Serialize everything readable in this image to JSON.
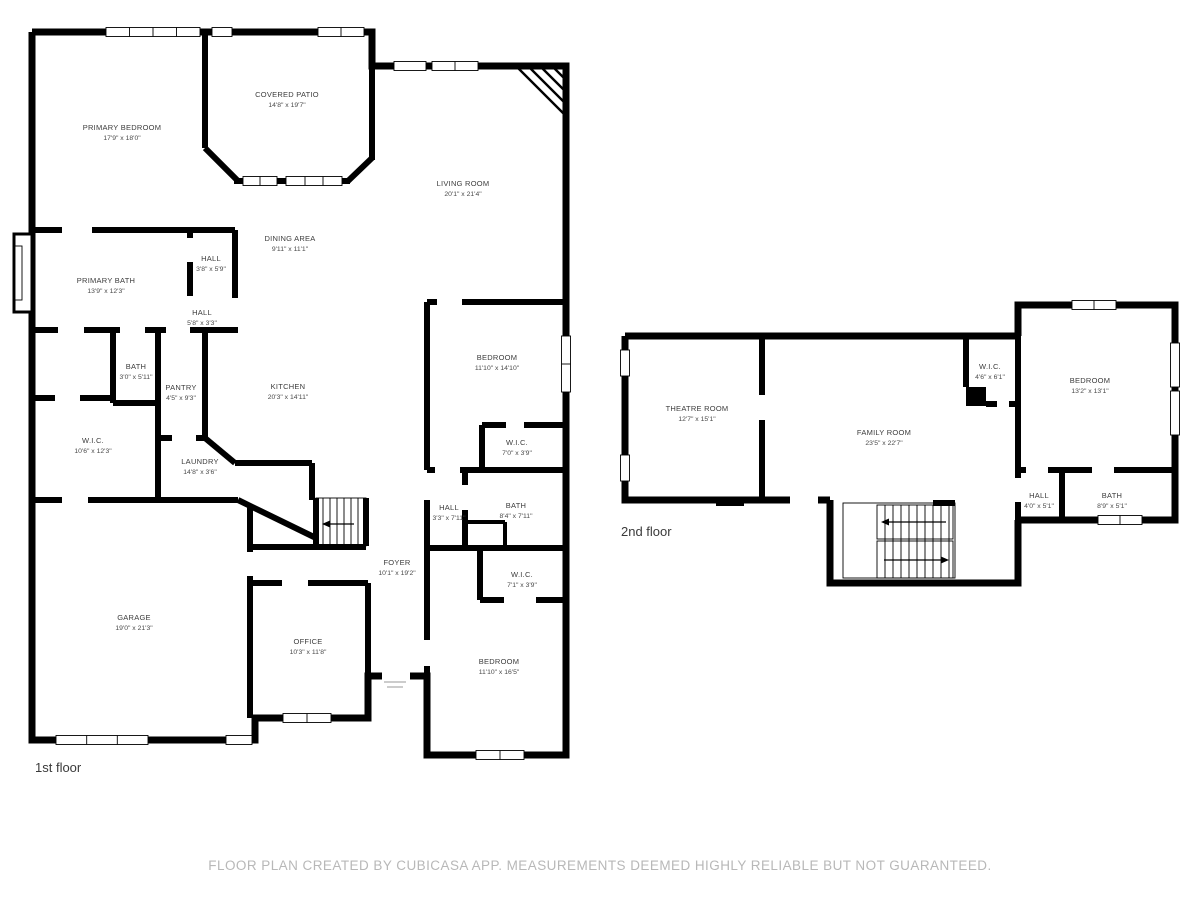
{
  "footer": {
    "disclaimer": "FLOOR PLAN CREATED BY CUBICASA APP. MEASUREMENTS DEEMED HIGHLY RELIABLE BUT NOT GUARANTEED."
  },
  "colors": {
    "wall": "#000000",
    "background": "#ffffff",
    "room_label_text": "#3c3c3c",
    "floor_label_text": "#3a3a3a",
    "disclaimer_text": "#b8b8b8"
  },
  "floors": [
    {
      "label": "1st floor",
      "rooms": [
        {
          "name": "PRIMARY BEDROOM",
          "dims": "17'9\" x 18'0\""
        },
        {
          "name": "COVERED PATIO",
          "dims": "14'8\" x 19'7\""
        },
        {
          "name": "LIVING ROOM",
          "dims": "20'1\" x 21'4\""
        },
        {
          "name": "DINING AREA",
          "dims": "9'11\" x 11'1\""
        },
        {
          "name": "HALL",
          "dims": "3'8\" x 5'9\""
        },
        {
          "name": "PRIMARY BATH",
          "dims": "13'9\" x 12'3\""
        },
        {
          "name": "HALL",
          "dims": "5'8\" x 3'3\""
        },
        {
          "name": "BATH",
          "dims": "3'0\" x 5'11\""
        },
        {
          "name": "PANTRY",
          "dims": "4'5\" x 9'3\""
        },
        {
          "name": "KITCHEN",
          "dims": "20'3\" x 14'11\""
        },
        {
          "name": "BEDROOM",
          "dims": "11'10\" x 14'10\""
        },
        {
          "name": "W.I.C.",
          "dims": "10'6\" x 12'3\""
        },
        {
          "name": "LAUNDRY",
          "dims": "14'8\" x 3'6\""
        },
        {
          "name": "W.I.C.",
          "dims": "7'0\" x 3'9\""
        },
        {
          "name": "HALL",
          "dims": "3'3\" x 7'11\""
        },
        {
          "name": "BATH",
          "dims": "8'4\" x 7'11\""
        },
        {
          "name": "FOYER",
          "dims": "10'1\" x 19'2\""
        },
        {
          "name": "W.I.C.",
          "dims": "7'1\" x 3'9\""
        },
        {
          "name": "GARAGE",
          "dims": "19'0\" x 21'3\""
        },
        {
          "name": "OFFICE",
          "dims": "10'3\" x 11'8\""
        },
        {
          "name": "BEDROOM",
          "dims": "11'10\" x 16'5\""
        }
      ]
    },
    {
      "label": "2nd floor",
      "rooms": [
        {
          "name": "THEATRE ROOM",
          "dims": "12'7\" x 15'1\""
        },
        {
          "name": "FAMILY ROOM",
          "dims": "23'5\" x 22'7\""
        },
        {
          "name": "W.I.C.",
          "dims": "4'6\" x 6'1\""
        },
        {
          "name": "BEDROOM",
          "dims": "13'2\" x 13'1\""
        },
        {
          "name": "HALL",
          "dims": "4'0\" x 5'1\""
        },
        {
          "name": "BATH",
          "dims": "8'9\" x 5'1\""
        }
      ]
    }
  ]
}
